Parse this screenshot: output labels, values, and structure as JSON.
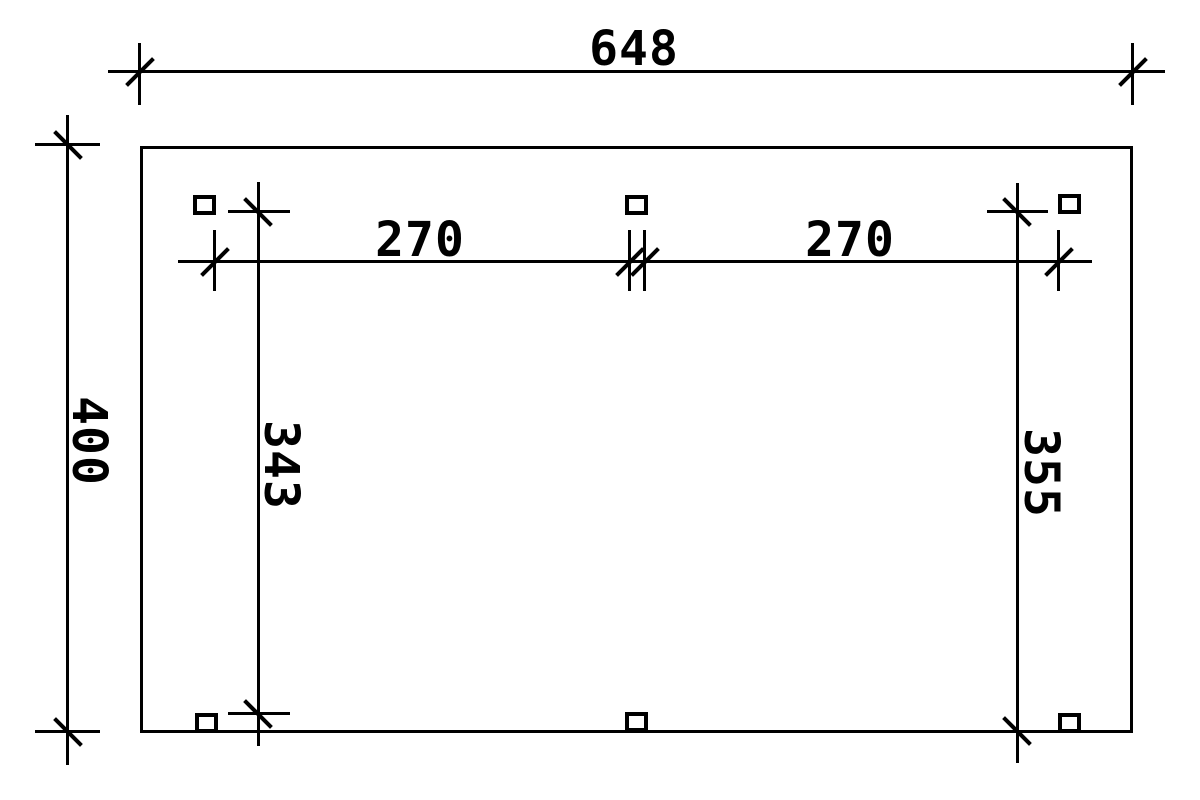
{
  "dims": {
    "total_width": "648",
    "total_depth": "400",
    "bay_left": "270",
    "bay_right": "270",
    "left_post_line_depth": "343",
    "right_post_line_depth": "355"
  },
  "colors": {
    "line": "#000000",
    "background": "#ffffff"
  }
}
